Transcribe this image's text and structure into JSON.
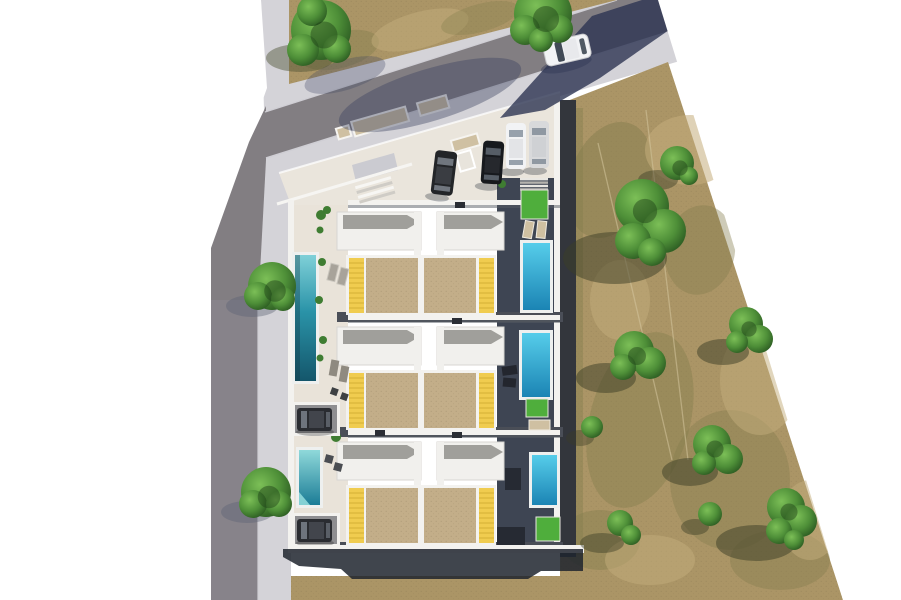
{
  "scene": {
    "kind": "aerial-3d-render",
    "description": "Top-down photorealistic render of a residential development: three rows of paired villas with private pools, a bent access road with sidewalks on the left/top, an entry plaza with parked cars, and a dry scrub field with trees on the right.",
    "site": {
      "building_rows": 3,
      "units_per_row": 2,
      "yellow_awnings": 6,
      "pools_west_teal": 2,
      "pools_east_cyan": 3,
      "lawn_patches": 4,
      "parking_courts": 2
    },
    "vehicles": {
      "road_car": "white car on upper road",
      "plaza_parked": [
        "dark car",
        "black suv",
        "white car",
        "silver car"
      ],
      "court_parked": [
        "dark car",
        "dark car"
      ],
      "total": 7
    },
    "vegetation": {
      "street_trees": 2,
      "corner_grove_trees": 2,
      "field_tree_clusters": 9
    }
  },
  "palette": {
    "background": "#ffffff",
    "road": "#827e82",
    "road_vertical": "#87838a",
    "sidewalk": "#d4d3d8",
    "curb": "#cfced4",
    "driveway_apron": "#cbcbd1",
    "plaza": "#eae5dc",
    "terrace_beige": "#e9e3d9",
    "field": "#ab9566",
    "field_olive": "#857e4e",
    "field_tan": "#c4ad7b",
    "path_line": "#d5c79e",
    "roof_white": "#f1f0ed",
    "roof_gray": "#a09f9b",
    "wall_white": "#f3f2ef",
    "divider_shadow": "#565b64",
    "patio_tan": "#c3ae89",
    "awning_yellow": "#f0cc4f",
    "awning_stripe": "#d9b53b",
    "alley_dark": "#4a4e57",
    "deck_navy": "#3e4553",
    "east_wall": "#33363c",
    "pool_rim": "#eef0ef",
    "pool_teal_light": "#7fd0d8",
    "pool_teal_dark": "#14566b",
    "pool_cyan_light": "#56cdea",
    "pool_cyan_dark": "#1b84b4",
    "lawn_green": "#4fae3c",
    "tree_light": "#7cbf57",
    "tree_mid": "#4e8f38",
    "tree_dark": "#27541f",
    "tree_core": "#1c3d16",
    "shadow_navy_road": "#2d3452",
    "shadow_soft_road": "#3a4160",
    "shadow_ground": "#3b3d26",
    "shadow_pavement": "#596273",
    "shadow_building": "#1f242e",
    "car_white": "#f2f3f5",
    "car_silver": "#d8d9db",
    "car_black": "#17191d",
    "car_dark": "#2a2c31",
    "car_glass": "#6e747d",
    "court_gray": "#8e8e91",
    "bench_tan": "#cfc0a2",
    "lounger_gray": "#a8a39a",
    "furniture_dark": "#23262e"
  }
}
